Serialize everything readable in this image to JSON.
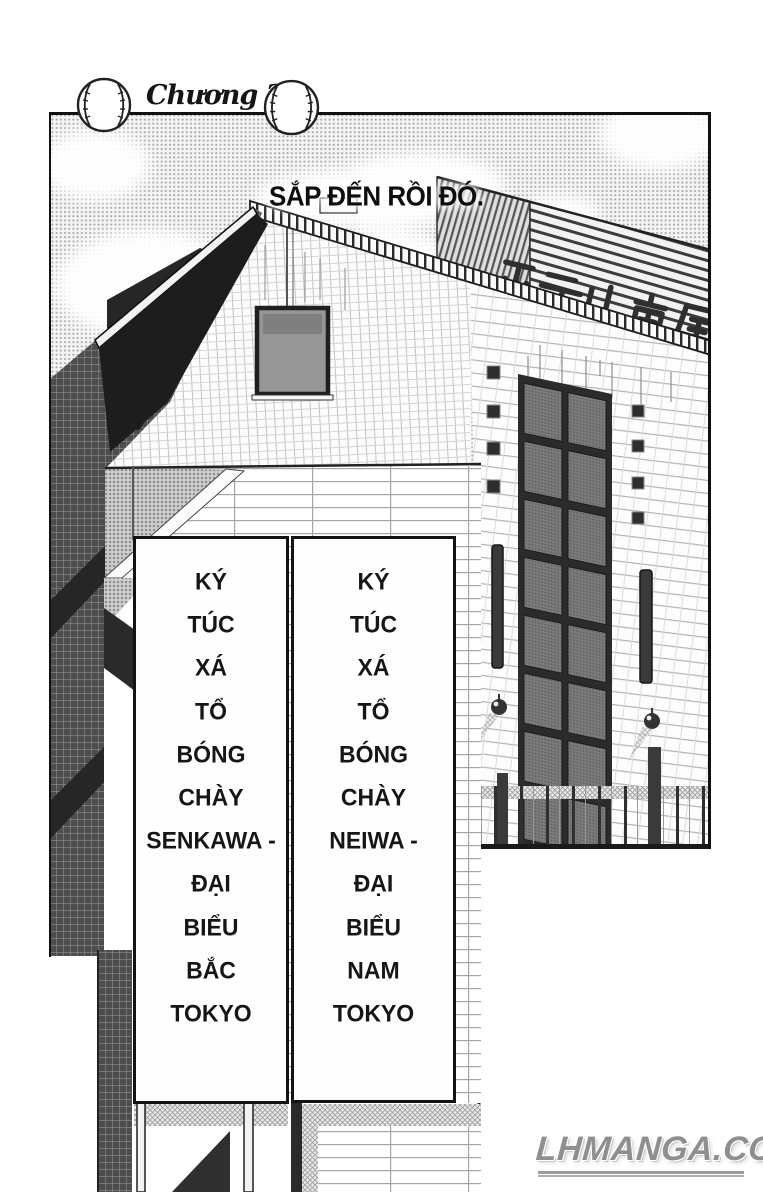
{
  "header": {
    "chapter_label": "Chương 2 :"
  },
  "caption": {
    "text": "SẮP ĐẾN RỒI ĐÓ."
  },
  "hotel_sign": {
    "text": "ホテル南風"
  },
  "signs": {
    "left": {
      "lines": [
        "KÝ",
        "TÚC",
        "XÁ",
        "TỔ",
        "BÓNG",
        "CHÀY",
        "SENKAWA -",
        "ĐẠI",
        "BIỂU",
        "BẮC",
        "TOKYO"
      ]
    },
    "right": {
      "lines": [
        "KÝ",
        "TÚC",
        "XÁ",
        "TỔ",
        "BÓNG",
        "CHÀY",
        "NEIWA -",
        "ĐẠI",
        "BIỂU",
        "NAM",
        "TOKYO"
      ]
    }
  },
  "watermark": {
    "text": "LHMANGA.COM"
  },
  "colors": {
    "ink": "#1a1a1a",
    "watermark_gray": "#8f8f8f",
    "pane_gray": "#767676"
  }
}
